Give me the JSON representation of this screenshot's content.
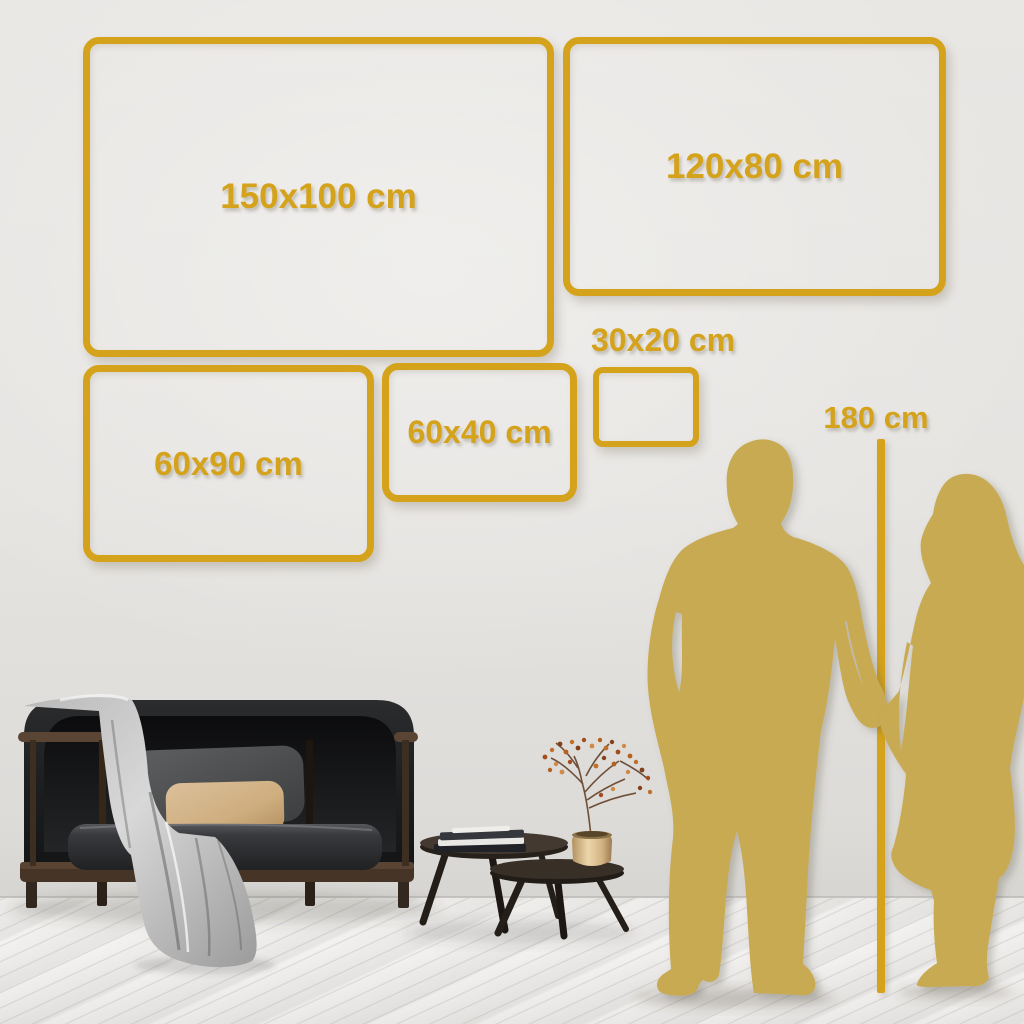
{
  "size_frames": [
    {
      "id": "150x100",
      "label": "150x100 cm"
    },
    {
      "id": "120x80",
      "label": "120x80 cm"
    },
    {
      "id": "60x90",
      "label": "60x90 cm"
    },
    {
      "id": "60x40",
      "label": "60x40 cm"
    },
    {
      "id": "30x20",
      "label": "30x20 cm"
    }
  ],
  "height_reference": {
    "label": "180 cm"
  },
  "colors": {
    "accent_gold": "#D5A21C",
    "silhouette_gold": "#C8AA52",
    "wall": "#E7E5E2",
    "floor": "#F2F1EF",
    "sofa": "#1E1F21",
    "pillow_gray": "#4D4F51",
    "pillow_accent": "#D3B488",
    "blanket": "#C9C9C9",
    "table_wood": "#352E27",
    "vase_brass": "#D8BA84",
    "branch_berries": "#B4601F"
  }
}
